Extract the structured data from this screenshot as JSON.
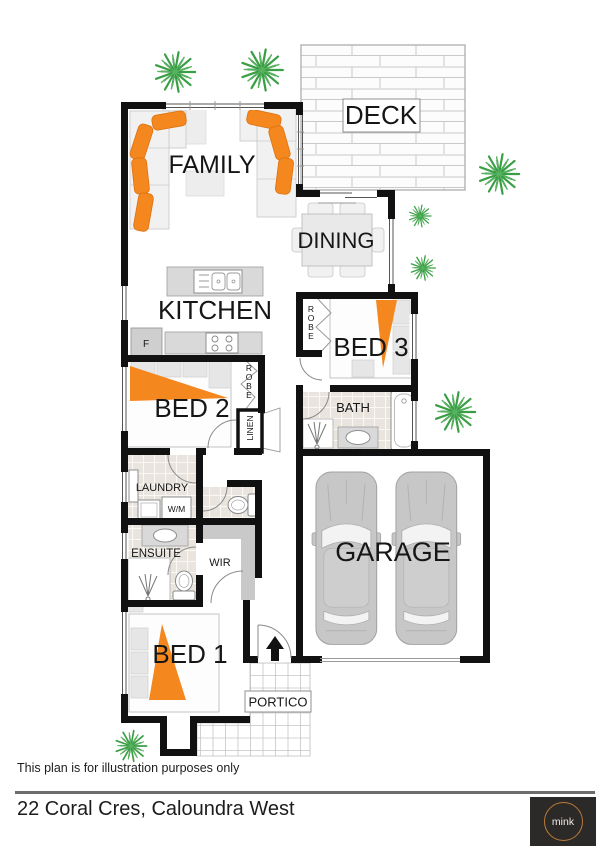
{
  "rooms": {
    "family": "FAMILY",
    "deck": "DECK",
    "dining": "DINING",
    "kitchen": "KITCHEN",
    "bed3": "BED 3",
    "bed2": "BED 2",
    "bath": "BATH",
    "laundry": "LAUNDRY",
    "ensuite": "ENSUITE",
    "wir": "WIR",
    "garage": "GARAGE",
    "bed1": "BED 1",
    "portico": "PORTICO"
  },
  "closets": {
    "robe_bed3": "ROBE",
    "robe_bed2": "ROBE",
    "linen": "LINEN"
  },
  "appliances": {
    "fridge": "F",
    "washing_machine": "W/M"
  },
  "colors": {
    "wall": "#111111",
    "accent_orange": "#f5871f",
    "plant_green": "#3a9e45",
    "tile_beige": "#e9e5de",
    "counter_grey": "#d9d9d9",
    "car_grey": "#c7c7c7",
    "logo_background": "#2c2a28",
    "logo_ring": "#bc7b33"
  },
  "footer": {
    "disclaimer": "This plan is for illustration purposes only",
    "address": "22 Coral Cres, Caloundra West",
    "logo_text": "mink"
  }
}
